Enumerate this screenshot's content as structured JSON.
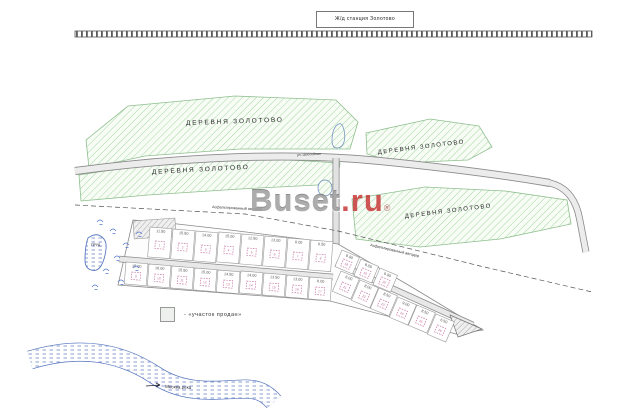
{
  "station_sign": "Ж/д станция Золотово",
  "labels": {
    "village": "ДЕРЕВНЯ ЗОЛОТОВО",
    "street": "ул. Шоссейная",
    "road": "Асфальтированный автодор",
    "pond": "ПРУД",
    "river": "Москва река"
  },
  "legend_text": "- «участок продан»",
  "watermark": {
    "brand": "Buset",
    "domain": ".ru",
    "reg": "®"
  },
  "colors": {
    "village_hatch": "#a5d6a5",
    "water": "#5a78c0",
    "lot_symbol_pink": "#c878a6",
    "watermark_red": "#c63232",
    "road_fill": "#ececec"
  },
  "lots": [
    {
      "x": 133,
      "y": 221,
      "w": 42,
      "h": 18,
      "rot": -4,
      "sold": true
    },
    {
      "x": 150,
      "y": 227,
      "w": 22,
      "h": 30,
      "rot": 4.5,
      "area": "11.50",
      "n": "1"
    },
    {
      "x": 173,
      "y": 229,
      "w": 22,
      "h": 30,
      "rot": 4.5,
      "area": "15.50",
      "n": "2"
    },
    {
      "x": 196,
      "y": 231,
      "w": 22,
      "h": 30,
      "rot": 4.5,
      "area": "14.00",
      "n": "3"
    },
    {
      "x": 219,
      "y": 232,
      "w": 22,
      "h": 30,
      "rot": 4.5,
      "area": "15.00",
      "n": "4"
    },
    {
      "x": 242,
      "y": 234,
      "w": 22,
      "h": 30,
      "rot": 4.5,
      "area": "12.50",
      "n": "5"
    },
    {
      "x": 265,
      "y": 236,
      "w": 22,
      "h": 30,
      "rot": 4.5,
      "area": "13.00",
      "n": "6"
    },
    {
      "x": 288,
      "y": 238,
      "w": 22,
      "h": 30,
      "rot": 4.5,
      "area": "8.00",
      "n": "7"
    },
    {
      "x": 311,
      "y": 240,
      "w": 22,
      "h": 30,
      "rot": 4.5,
      "area": "8.50",
      "n": "8"
    },
    {
      "x": 126,
      "y": 262,
      "w": 22,
      "h": 22,
      "rot": 4.5,
      "area": "15.00",
      "n": "9"
    },
    {
      "x": 149,
      "y": 264,
      "w": 22,
      "h": 22,
      "rot": 4.5,
      "area": "16.00",
      "n": "10"
    },
    {
      "x": 172,
      "y": 266,
      "w": 22,
      "h": 22,
      "rot": 4.5,
      "area": "15.50",
      "n": "11"
    },
    {
      "x": 195,
      "y": 268,
      "w": 22,
      "h": 22,
      "rot": 4.5,
      "area": "15.00",
      "n": "12"
    },
    {
      "x": 218,
      "y": 270,
      "w": 22,
      "h": 22,
      "rot": 4.5,
      "area": "14.50",
      "n": "13"
    },
    {
      "x": 241,
      "y": 271,
      "w": 22,
      "h": 22,
      "rot": 4.5,
      "area": "14.00",
      "n": "14"
    },
    {
      "x": 264,
      "y": 273,
      "w": 22,
      "h": 22,
      "rot": 4.5,
      "area": "13.50",
      "n": "15"
    },
    {
      "x": 287,
      "y": 275,
      "w": 22,
      "h": 22,
      "rot": 4.5,
      "area": "13.00",
      "n": "16"
    },
    {
      "x": 310,
      "y": 277,
      "w": 22,
      "h": 22,
      "rot": 4.5,
      "area": "8.00",
      "n": "17"
    },
    {
      "x": 342,
      "y": 250,
      "w": 19,
      "h": 18,
      "rot": 23,
      "area": "8.00",
      "n": "18"
    },
    {
      "x": 361,
      "y": 259,
      "w": 19,
      "h": 18,
      "rot": 23,
      "area": "8.50",
      "n": "19"
    },
    {
      "x": 380,
      "y": 268,
      "w": 19,
      "h": 18,
      "rot": 23,
      "area": "6.00",
      "n": "20"
    },
    {
      "x": 341,
      "y": 271,
      "w": 20,
      "h": 22,
      "rot": 23,
      "area": "6.00",
      "n": "21"
    },
    {
      "x": 360,
      "y": 280,
      "w": 20,
      "h": 22,
      "rot": 23,
      "area": "8.00",
      "n": "22"
    },
    {
      "x": 379,
      "y": 288,
      "w": 20,
      "h": 22,
      "rot": 23,
      "area": "8.50",
      "n": "23"
    },
    {
      "x": 398,
      "y": 297,
      "w": 20,
      "h": 22,
      "rot": 23,
      "area": "9.00",
      "n": "24"
    },
    {
      "x": 417,
      "y": 305,
      "w": 20,
      "h": 22,
      "rot": 23,
      "area": "8.50",
      "n": "25"
    },
    {
      "x": 436,
      "y": 314,
      "w": 20,
      "h": 22,
      "rot": 23,
      "area": "6.50",
      "n": "26"
    }
  ]
}
